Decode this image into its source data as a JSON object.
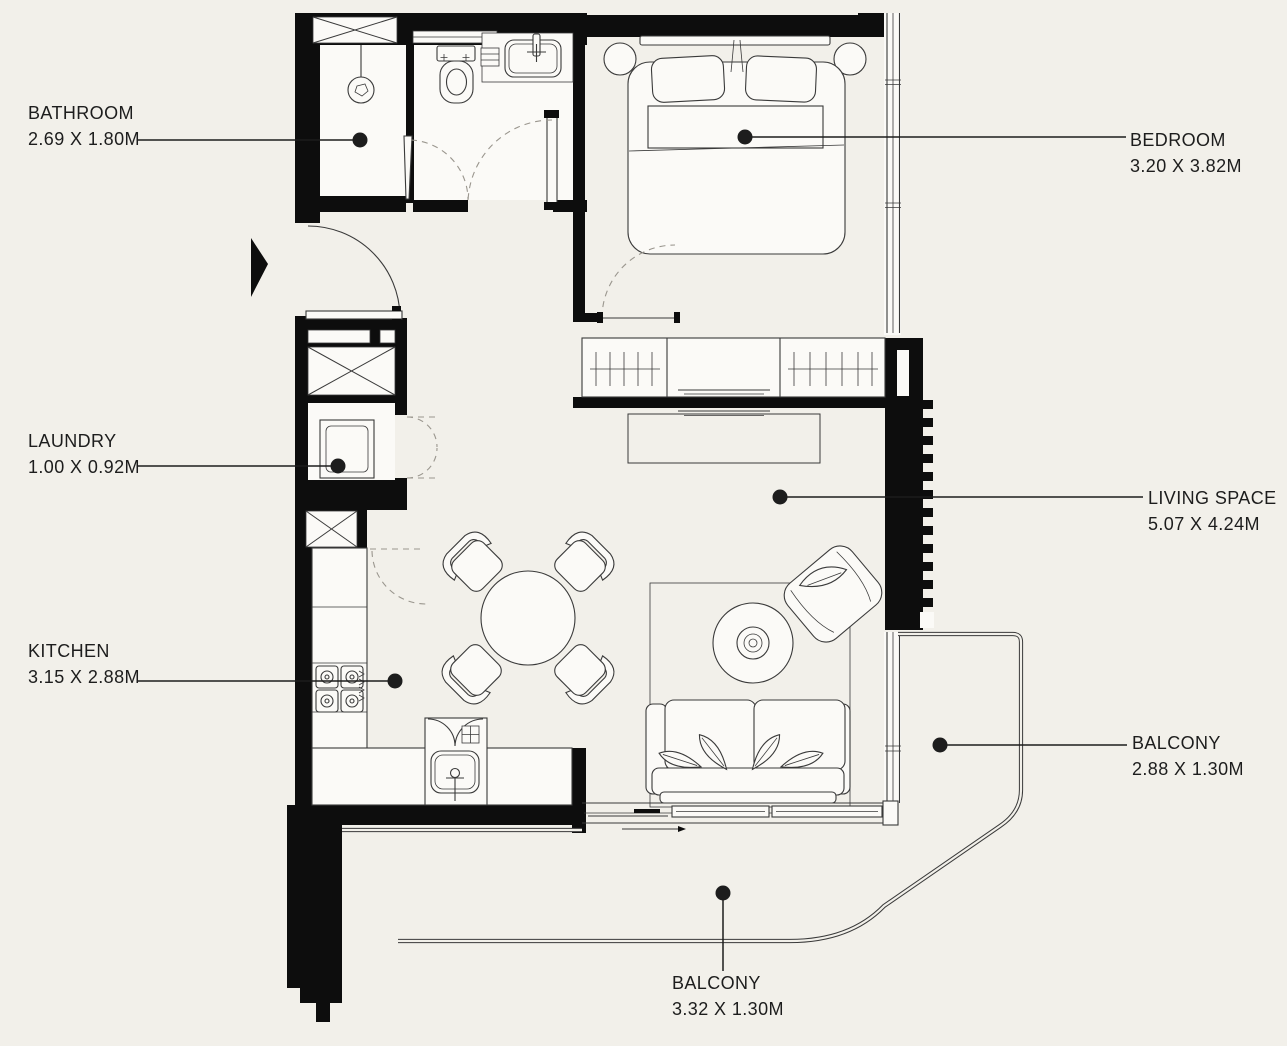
{
  "colors": {
    "background": "#f2f0ea",
    "paper": "#fbfaf7",
    "wall": "#0d0d0d",
    "line": "#3a3a3a",
    "softline": "#9a968e",
    "text": "#1d1d1d"
  },
  "rooms": [
    {
      "id": "bathroom",
      "name": "BATHROOM",
      "dims": "2.69 X 1.80M"
    },
    {
      "id": "bedroom",
      "name": "BEDROOM",
      "dims": "3.20 X 3.82M"
    },
    {
      "id": "laundry",
      "name": "LAUNDRY",
      "dims": "1.00 X 0.92M"
    },
    {
      "id": "living-space",
      "name": "LIVING SPACE",
      "dims": "5.07 X 4.24M"
    },
    {
      "id": "kitchen",
      "name": "KITCHEN",
      "dims": "3.15 X 2.88M"
    },
    {
      "id": "balcony-right",
      "name": "BALCONY",
      "dims": "2.88 X 1.30M"
    },
    {
      "id": "balcony-bottom",
      "name": "BALCONY",
      "dims": "3.32 X 1.30M"
    }
  ]
}
